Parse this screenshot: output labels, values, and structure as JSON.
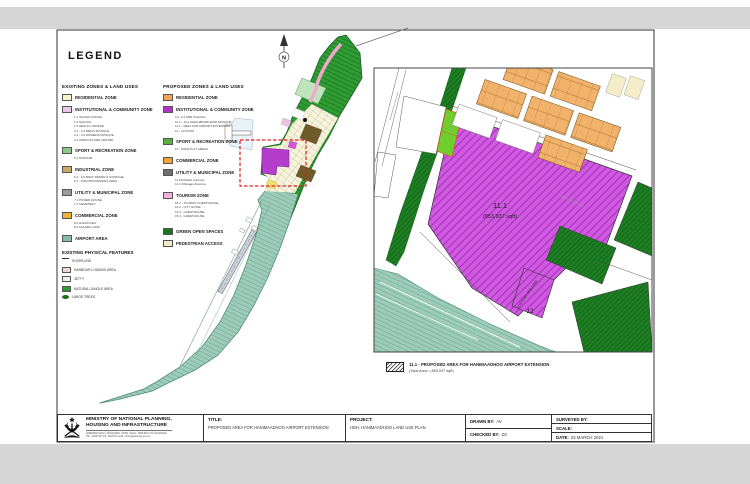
{
  "legend": {
    "title": "LEGEND",
    "existing": {
      "heading": "EXISTING ZONES & LAND USES",
      "items": [
        {
          "label": "RESIDENTIAL ZONE",
          "color": "#f8f3c6",
          "subs": []
        },
        {
          "label": "INSTITUTIONAL & COMMUNITY ZONE",
          "color": "#eac5ea",
          "subs": [
            "1.1 ISLAND OFFICE",
            "1.2 SCHOOL",
            "1.3 HEALTH CENTRE",
            "2.1 - 2.2 MEN'S MOSQUE",
            "3.1 - 3.2 WOMENS MOSQUE",
            "4.1 AGRICULTURE CENTRE"
          ]
        },
        {
          "label": "SPORT & RECREATION ZONE",
          "color": "#8cc88c",
          "subs": [
            "5.1 STADIUM"
          ]
        },
        {
          "label": "INDUSTRIAL ZONE",
          "color": "#c9a96e",
          "subs": [
            "6.1 - 6.6 BOAT REPAIR & STORAGE",
            "6.7 - FISH PROCESSING AREA"
          ]
        },
        {
          "label": "UTILITY & MUNICIPAL ZONE",
          "color": "#9a9a9a",
          "subs": [
            "7.1 POWER HOUSE",
            "7.2 CEMETERY"
          ]
        },
        {
          "label": "COMMERCIAL ZONE",
          "color": "#f0b23c",
          "subs": [
            "8.2 HUDHUVELI",
            "8.3 LEASED LAND"
          ]
        },
        {
          "label": "AIRPORT AREA",
          "color": "#85bba8",
          "subs": []
        }
      ]
    },
    "physical": {
      "heading": "EXISTING PHYSICAL FEATURES",
      "items": [
        {
          "label": "SHORELINE"
        },
        {
          "label": "HARBOUR LOADING AREA",
          "color": "#f0d9d2"
        },
        {
          "label": "JETTY",
          "color": "#f4f0e4"
        },
        {
          "label": "NATURAL/JUNGLE AREA",
          "color": "#2e9b33"
        },
        {
          "label": "LARGE TREES",
          "color": "#1a6b1a"
        }
      ]
    },
    "proposed": {
      "heading": "PROPOSED ZONES & LAND USES",
      "items": [
        {
          "label": "RESIDENTIAL ZONE",
          "color": "#f1a757",
          "subs": []
        },
        {
          "label": "INSTITUTIONAL & COMMUNITY ZONE",
          "color": "#b431c8",
          "subs": [
            "9.1- 9.2 PRE SCHOOL",
            "10.1 - 10.2 NEIGHBOURHOOD MOSQUE",
            "11.1 - AREA FOR AIRPORT EXTENSION",
            "12 - CUSTOM"
          ]
        },
        {
          "label": "SPORT & RECREATION ZONE",
          "color": "#5aae3c",
          "subs": [
            "13 - SAFE PLAY AREAS"
          ]
        },
        {
          "label": "COMMERCIAL ZONE",
          "color": "#f0a43a",
          "subs": []
        },
        {
          "label": "UTILITY & MUNICIPAL ZONE",
          "color": "#6e6e6e",
          "subs": [
            "14 FM Radio Antenna",
            "14.1 Dhiraagu Antenna"
          ]
        },
        {
          "label": "TOURISM ZONE",
          "color": "#f2aede",
          "subs": [
            "15.1 - TOURIST GUESTHOUSE",
            "15.2 - CITY HOTEL",
            "15.3 - GUESTHOUSE",
            "15.4 - GUESTHOUSE"
          ]
        },
        {
          "label": "GREEN OPEN SPACES",
          "color": "#17771c",
          "subs": []
        },
        {
          "label": "PEDESTRIAN ACCESS",
          "color": "#e9e9c4",
          "subs": []
        }
      ]
    }
  },
  "map": {
    "north": "N"
  },
  "inset": {
    "area_id": "11.1",
    "area_size": "(853,937 sqft)",
    "customs_building": "CUSTOMS BUILDING",
    "customs_id": "12",
    "caption_title": "11.1 - PROPOSED AREA FOR HANIMAADHOO AIRPORT EXTENSION",
    "caption_area": "(Total Area = 853,937 sqft)"
  },
  "titleblock": {
    "ministry_line1": "MINISTRY OF NATIONAL PLANNING,",
    "ministry_line2": "HOUSING AND INFRASTRUCTURE",
    "address": "AMEENEE MAGU, MAAFANNU, 20392, MALE', REPUBLIC OF MALDIVES",
    "contact": "TEL: 4004700   FAX: 4004701   email: urban@planning.gov.mv",
    "title_label": "TITLE:",
    "title_value": "PROPOSED AREA FOR HANIMAADHOO AIRPORT EXTENSION",
    "project_label": "PROJECT:",
    "project_value": "HDH. HANIMAADHOO LAND USE PLAN",
    "drawn_label": "DRAWN BY:",
    "drawn_value": "AV",
    "checked_label": "CHECKED BY:",
    "checked_value": "ZS",
    "surveyed_label": "SURVEYED BY:",
    "scale_label": "SCALE:",
    "date_label": "DATE:",
    "date_value": "22 MARCH 2021"
  }
}
